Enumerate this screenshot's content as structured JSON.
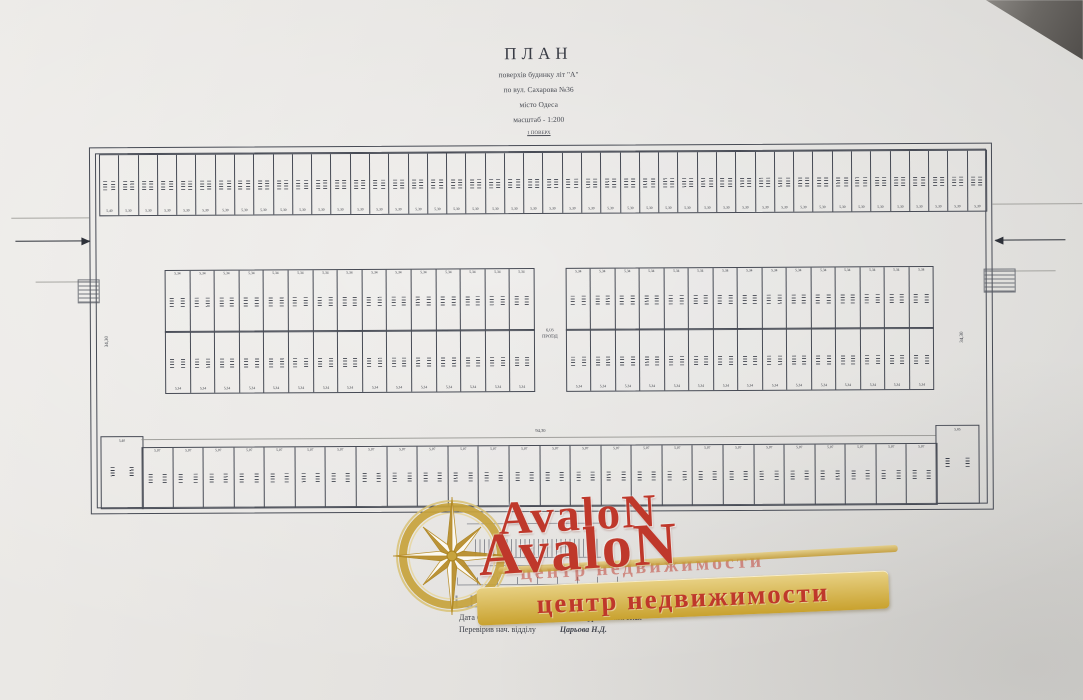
{
  "colors": {
    "accent_red": "#bf382b",
    "gold": "#c79d3a",
    "ink": "#3e424c"
  },
  "title_block": {
    "line1": "ПЛАН",
    "line2": "поверхів будинку літ \"А\"",
    "line3": "по вул. Сахарова №36",
    "line4": "місто Одеса",
    "line5": "масштаб - 1:200",
    "line6": "1 ПОВЕРХ"
  },
  "plan": {
    "rows": [
      {
        "name": "top",
        "x": 100,
        "y": 152,
        "w": 886,
        "h": 60,
        "count": 46,
        "dim": "5,30",
        "first_dim": "5,40",
        "dimPos": "bottom"
      },
      {
        "name": "mid-left-upper",
        "x": 165,
        "y": 268,
        "w": 368,
        "h": 61,
        "count": 15,
        "dim": "5,34",
        "dimPos": "top"
      },
      {
        "name": "mid-left-lower",
        "x": 165,
        "y": 329,
        "w": 368,
        "h": 61,
        "count": 15,
        "dim": "5,34",
        "dimPos": "bottom"
      },
      {
        "name": "mid-right-upper",
        "x": 566,
        "y": 268,
        "w": 366,
        "h": 61,
        "count": 15,
        "dim": "5,34",
        "dimPos": "top"
      },
      {
        "name": "mid-right-lower",
        "x": 566,
        "y": 329,
        "w": 366,
        "h": 61,
        "count": 15,
        "dim": "5,34",
        "dimPos": "bottom"
      },
      {
        "name": "bottom",
        "x": 141,
        "y": 445,
        "w": 794,
        "h": 60,
        "count": 26,
        "dim": "5,07",
        "dimPos": "top"
      }
    ],
    "left_corner_stall_dim": "5,40",
    "right_corner_stall_dim": "5,85",
    "aisle_label_top": "6,05",
    "aisle_label_bottom": "ПРОЇЗД",
    "left_depth_dim": "34,30",
    "right_depth_dim": "34,30",
    "bottom_length_dim": "94,30"
  },
  "watermark": {
    "brand_small": "AvaloN",
    "brand_large": "AvaloN",
    "tagline": "центр недвижимости",
    "tagline_shadow": "центр недвижимости"
  },
  "footer": {
    "date": "Дата 02.11.2007 р.",
    "role1": "Виконав",
    "name1": "Журанський П.В.",
    "role2": "Перевірив нач. відділу",
    "name2": "Царьова Н.Д."
  }
}
